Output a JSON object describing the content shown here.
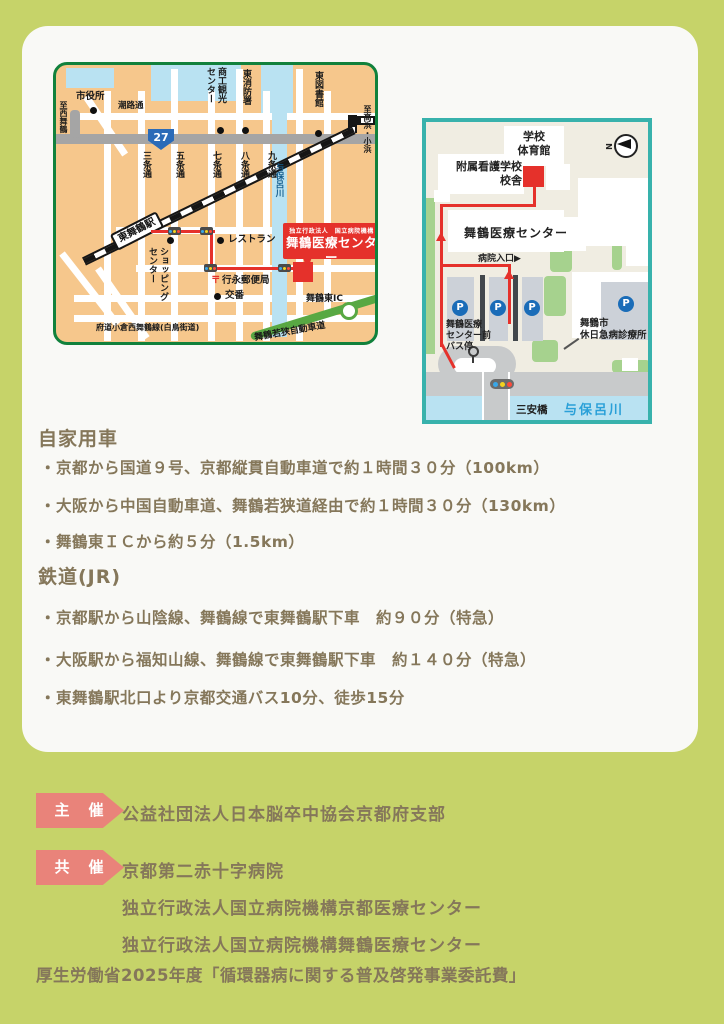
{
  "colors": {
    "page_bg": "#c6d369",
    "card_bg": "#f9f9f6",
    "accent_red": "#e5312b",
    "badge_pink": "#e9837a",
    "text_brown": "#85775a",
    "city_map_bg": "#f6c78c",
    "city_map_border": "#11813c",
    "campus_border": "#38b2ac",
    "water_blue": "#b9e2f2",
    "expressway_green": "#58a843",
    "parking_p_blue": "#1a6cb8"
  },
  "city_map": {
    "to_west": "至西舞鶴",
    "to_east": "至高浜・小浜",
    "city_hall": "市役所",
    "shioji_street": "潮路通",
    "chamber": "商工観光センター",
    "fire_station": "東消防署",
    "library": "東図書館",
    "route_number": "27",
    "streets": [
      "三条通",
      "五条通",
      "七条通",
      "八条通",
      "九条通"
    ],
    "river": "与保呂川",
    "station": "東舞鶴駅",
    "shopping": "ショッピングセンター",
    "restaurant": "レストラン",
    "post_mark": "〒",
    "post_office": "行永郵便局",
    "police_box": "交番",
    "pref_road": "府道小倉西舞鶴線(白鳥街道)",
    "interchange": "舞鶴東IC",
    "expressway": "舞鶴若狭自動車道",
    "callout_org": "独立行政法人　国立病院機構",
    "callout_name": "舞鶴医療センター"
  },
  "campus_map": {
    "compass": "N",
    "gym": "学校\n体育館",
    "school_line1": "附属看護学校",
    "school_line2": "校舎",
    "center": "舞鶴医療センター",
    "entrance": "病院入口▶",
    "bus_stop": "舞鶴医療\nセンター前\nバス停",
    "clinic_line1": "舞鶴市",
    "clinic_line2": "休日急病診療所",
    "parking_mark": "P",
    "bridge": "三安橋",
    "river": "与保呂川"
  },
  "access": {
    "car": {
      "heading": "自家用車",
      "items": [
        "・京都から国道９号、京都縦貫自動車道で約１時間３０分（100km）",
        "・大阪から中国自動車道、舞鶴若狭道経由で約１時間３０分（130km）",
        "・舞鶴東ＩＣから約５分（1.5km）"
      ]
    },
    "train": {
      "heading": "鉄道(JR)",
      "items": [
        "・京都駅から山陰線、舞鶴線で東舞鶴駅下車　約９０分（特急）",
        "・大阪駅から福知山線、舞鶴線で東舞鶴駅下車　約１４０分（特急）",
        "・東舞鶴駅北口より京都交通バス10分、徒歩15分"
      ]
    }
  },
  "organizers": {
    "host_badge": "主　催",
    "host_name": "公益社団法人日本脳卒中協会京都府支部",
    "cohost_badge": "共　催",
    "cohost_names": [
      "京都第二赤十字病院",
      "独立行政法人国立病院機構京都医療センター",
      "独立行政法人国立病院機構舞鶴医療センター"
    ]
  },
  "footer": "厚生労働省2025年度「循環器病に関する普及啓発事業委託費」"
}
